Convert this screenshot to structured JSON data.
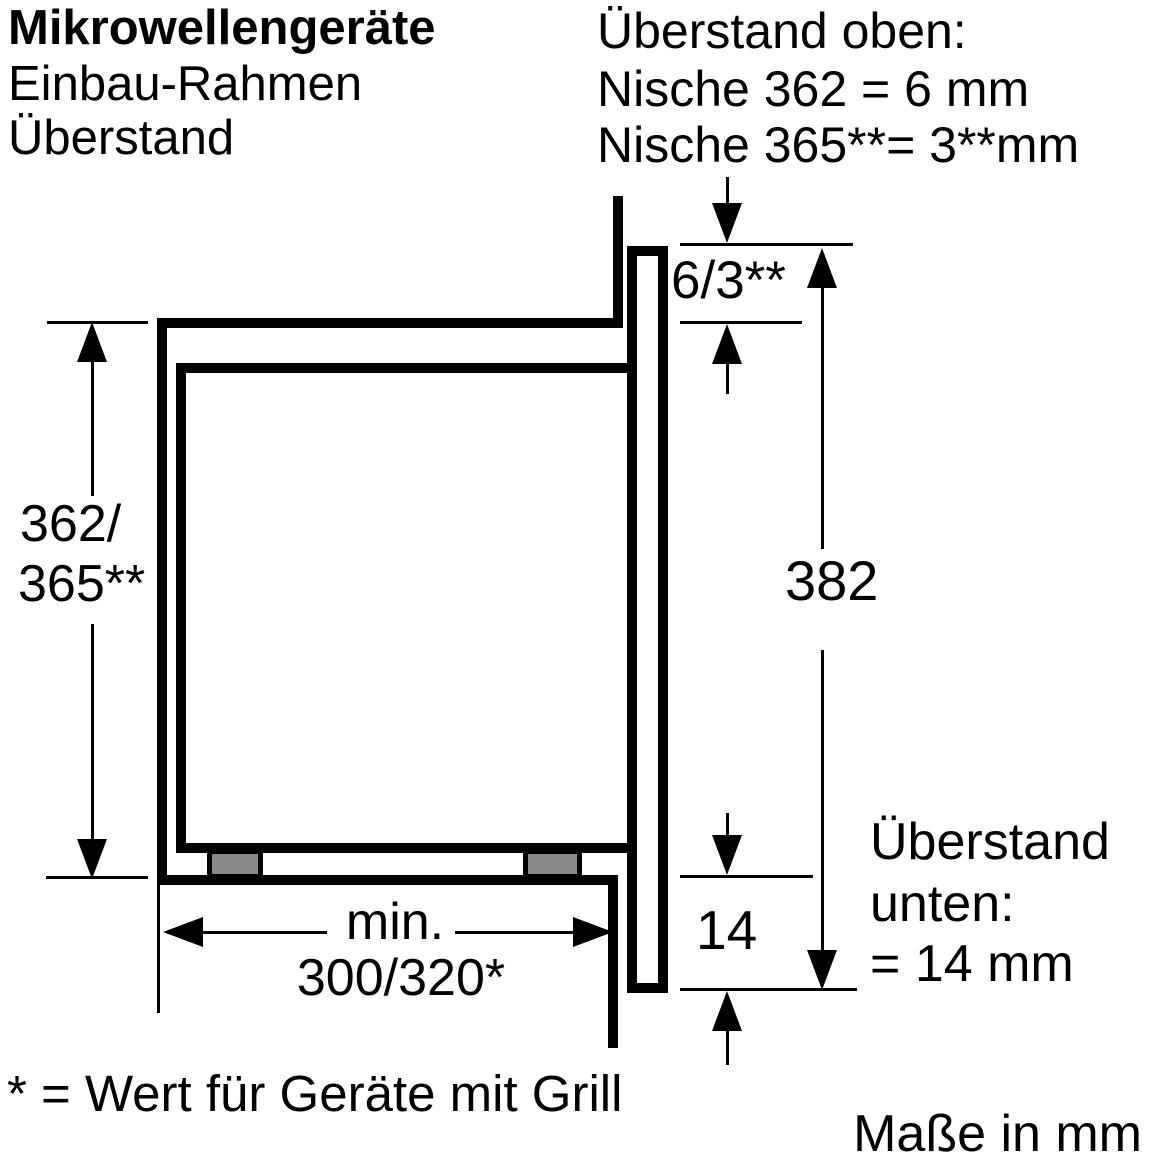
{
  "title": {
    "line1": "Mikrowellengeräte",
    "line2": "Einbau-Rahmen",
    "line3": "Überstand"
  },
  "note_top_right": {
    "line1": "Überstand oben:",
    "line2": "Nische 362 = 6 mm",
    "line3": "Nische 365**= 3**mm"
  },
  "note_bottom_right": {
    "line1": "Überstand",
    "line2": "unten:",
    "line3": "= 14 mm"
  },
  "labels": {
    "niche_height_line1": "362/",
    "niche_height_line2": "365**",
    "overhang_top": "6/3**",
    "frame_height": "382",
    "overhang_bottom": "14",
    "width_min_prefix": "min.",
    "width_min_value": "300/320*"
  },
  "footnote": "* = Wert für Geräte mit Grill",
  "units": "Maße in mm",
  "colors": {
    "line": "#000000",
    "background": "#ffffff",
    "foot_fill": "#8a8a8a"
  }
}
